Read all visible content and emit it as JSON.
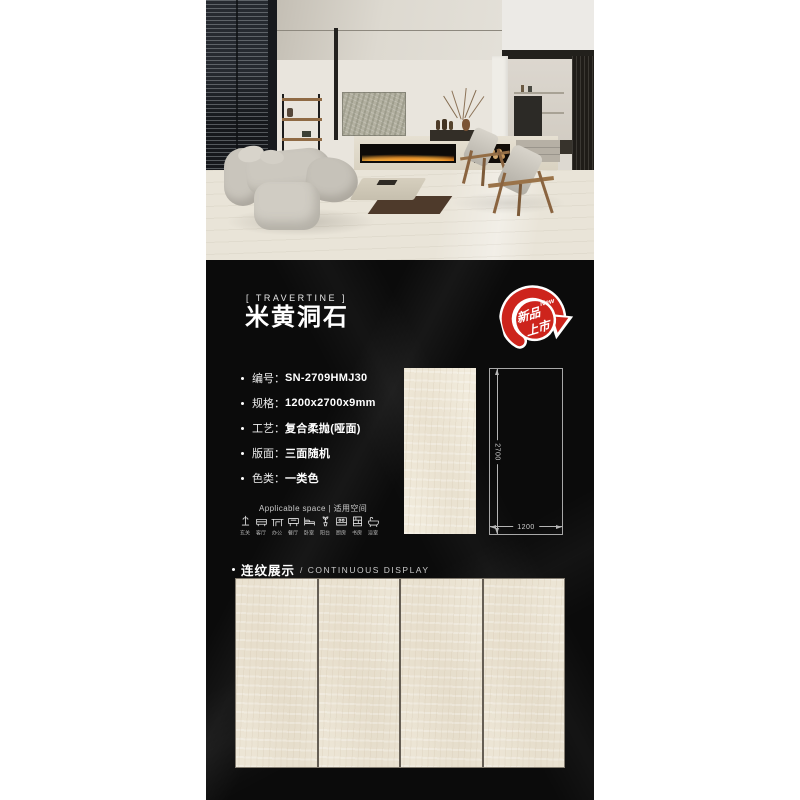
{
  "product": {
    "category_tag": "[ TRAVERTINE ]",
    "title": "米黄洞石",
    "badge": {
      "zh_top": "新品",
      "zh_bottom": "上市",
      "en": "New"
    },
    "specs": [
      {
        "label": "编号：",
        "value": "SN-2709HMJ30"
      },
      {
        "label": "规格：",
        "value": "1200x2700x9mm"
      },
      {
        "label": "工艺：",
        "value": "复合柔抛(哑面)"
      },
      {
        "label": "版面：",
        "value": "三面随机"
      },
      {
        "label": "色类：",
        "value": "一类色"
      }
    ],
    "applicable_space": {
      "heading": "Applicable space | 适用空间",
      "items": [
        {
          "icon": "coat-rack-icon",
          "label": "玄关"
        },
        {
          "icon": "sofa-icon",
          "label": "客厅"
        },
        {
          "icon": "desk-icon",
          "label": "办公"
        },
        {
          "icon": "dining-table-icon",
          "label": "餐厅"
        },
        {
          "icon": "bed-icon",
          "label": "卧室"
        },
        {
          "icon": "plant-icon",
          "label": "阳台"
        },
        {
          "icon": "stove-icon",
          "label": "厨房"
        },
        {
          "icon": "bookshelf-icon",
          "label": "书房"
        },
        {
          "icon": "bathtub-icon",
          "label": "浴室"
        }
      ]
    },
    "dimension_diagram": {
      "height_mm": "2700",
      "width_mm": "1200"
    },
    "continuous_display": {
      "zh": "连纹展示",
      "en": "/ CONTINUOUS DISPLAY"
    }
  },
  "colors": {
    "panel_black": "#0b0b0b",
    "tile_cream": "#ece5d5",
    "sample_cream": "#f1ebdc",
    "accent_red": "#cd241c",
    "text_white": "#ffffff"
  }
}
